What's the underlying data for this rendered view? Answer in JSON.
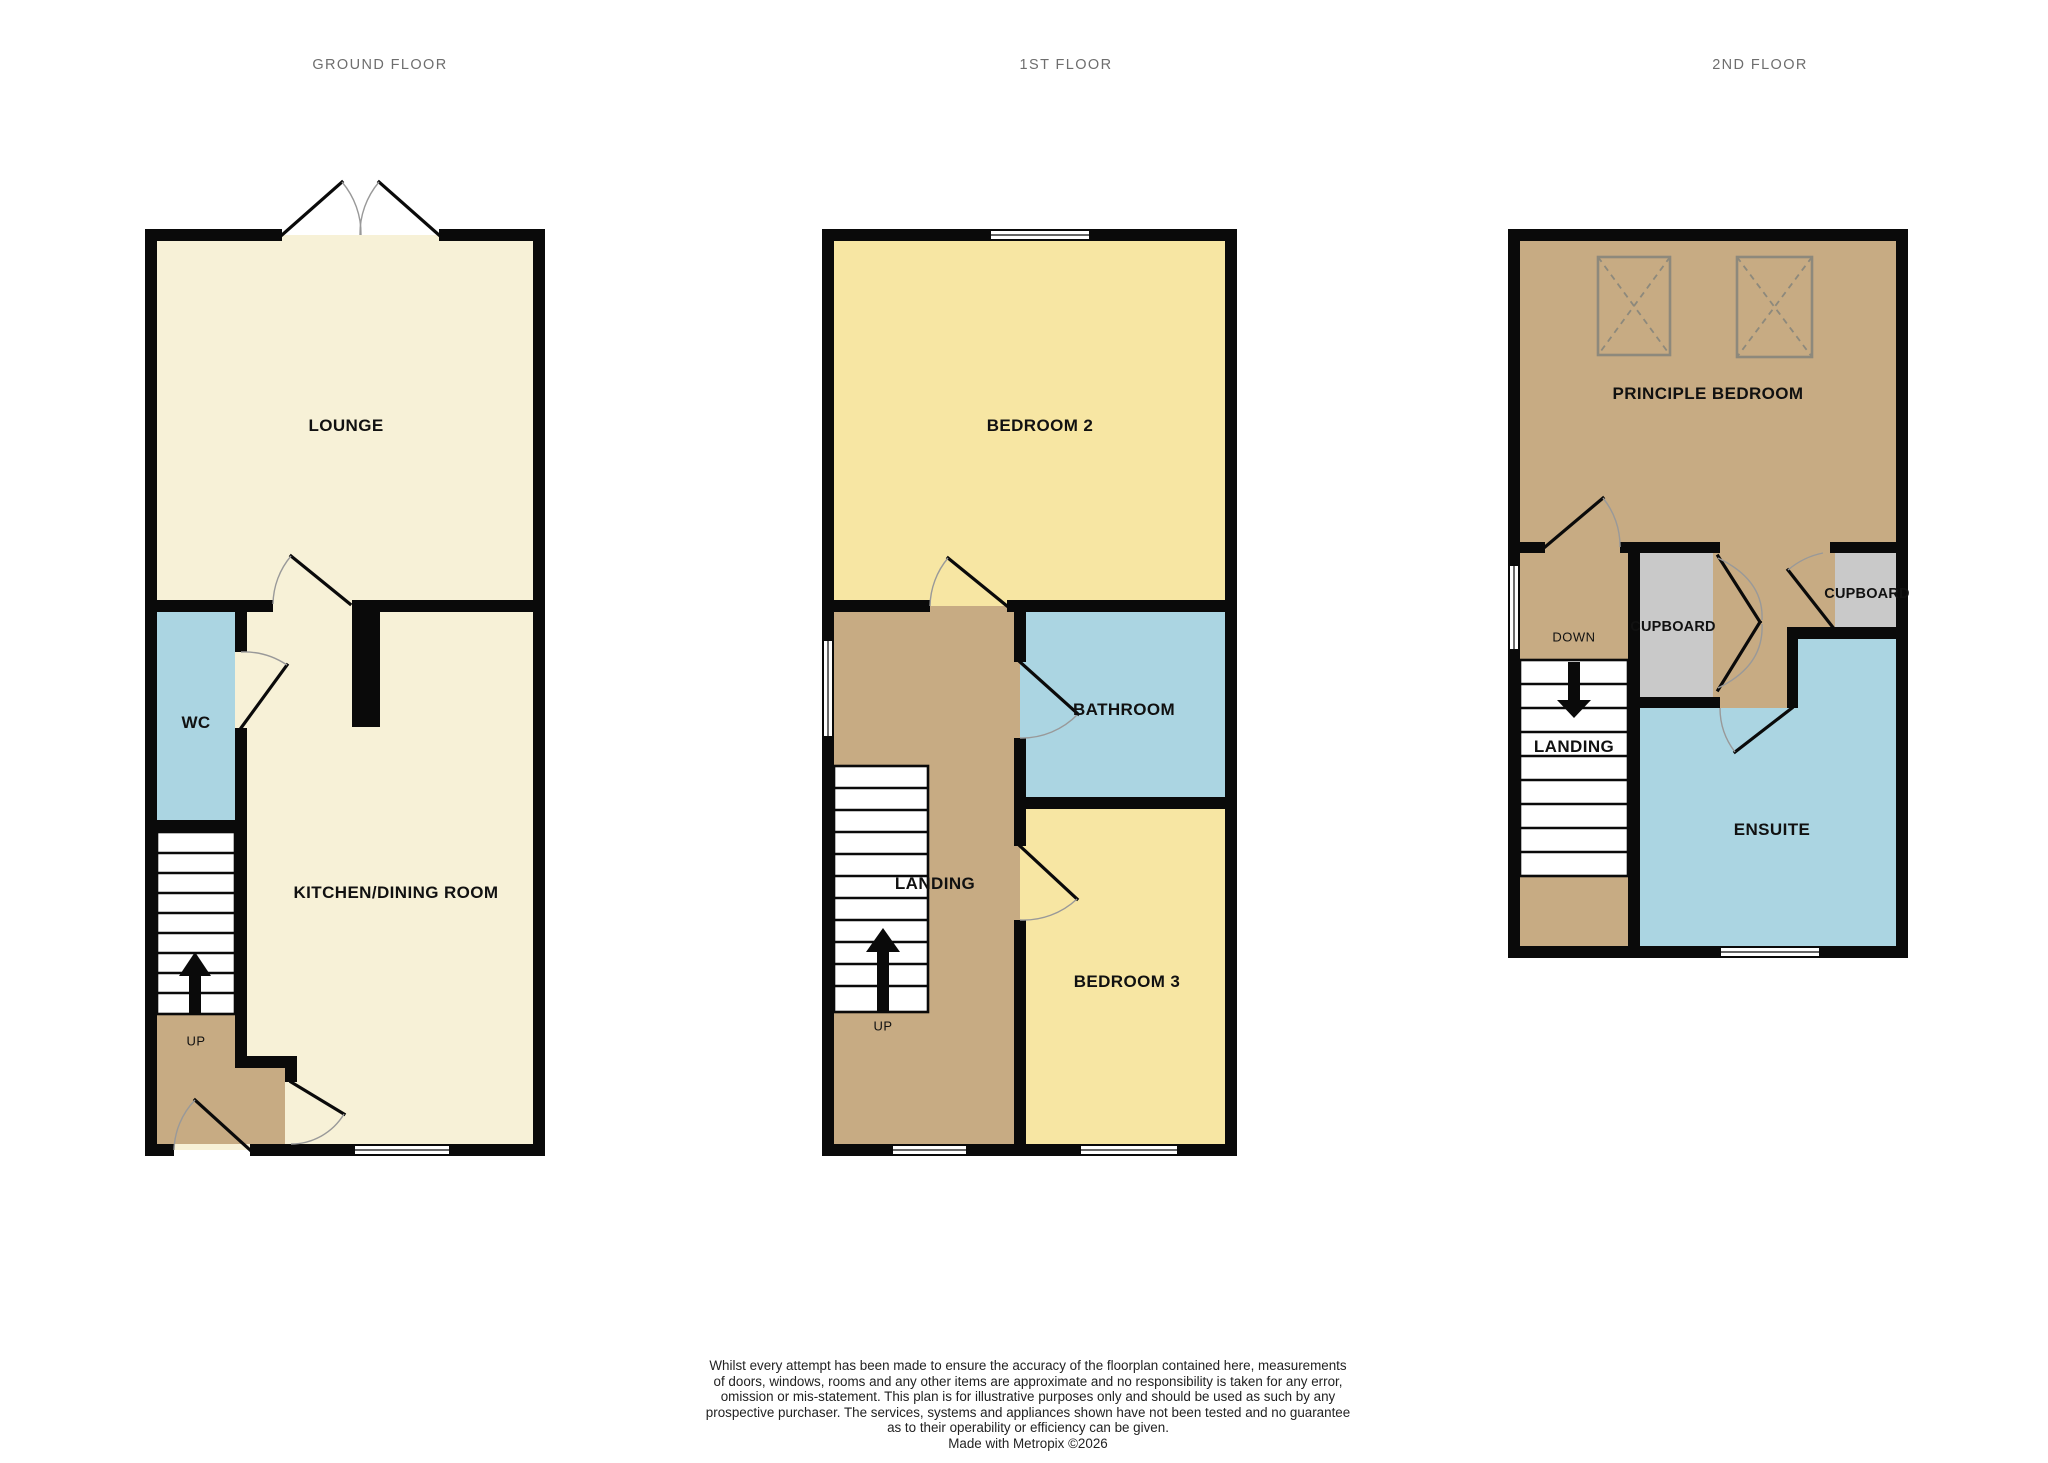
{
  "titles": {
    "ground": "GROUND FLOOR",
    "first": "1ST FLOOR",
    "second": "2ND FLOOR"
  },
  "rooms": {
    "lounge": "LOUNGE",
    "wc": "WC",
    "kitchen": "KITCHEN/DINING ROOM",
    "up_ground": "UP",
    "bedroom2": "BEDROOM 2",
    "bathroom": "BATHROOM",
    "landing_first": "LANDING",
    "bedroom3": "BEDROOM 3",
    "up_first": "UP",
    "principle_bedroom": "PRINCIPLE BEDROOM",
    "down_second": "DOWN",
    "cupboard_mid": "CUPBOARD",
    "cupboard_right": "CUPBOARD",
    "landing_second": "LANDING",
    "ensuite": "ENSUITE"
  },
  "disclaimer": {
    "lines": [
      "Whilst every attempt has been made to ensure the accuracy of the floorplan contained here, measurements",
      "of doors, windows, rooms and any other items are approximate and no responsibility is taken for any error,",
      "omission or mis-statement. This plan is for illustrative purposes only and should be used as such by any",
      "prospective purchaser. The services, systems and appliances shown have not been tested and no guarantee",
      "as to their operability or efficiency can be given.",
      "Made with Metropix ©2026"
    ]
  },
  "colors": {
    "cream": "#f7f1d7",
    "yellow": "#f7e6a3",
    "blue": "#abd5e2",
    "tan": "#c7ab83",
    "gray": "#c9c9c9",
    "wall": "#0a0a0a",
    "arc": "#999999",
    "skylight": "#8d897c",
    "title": "#6e6e6e",
    "label": "#111111"
  }
}
